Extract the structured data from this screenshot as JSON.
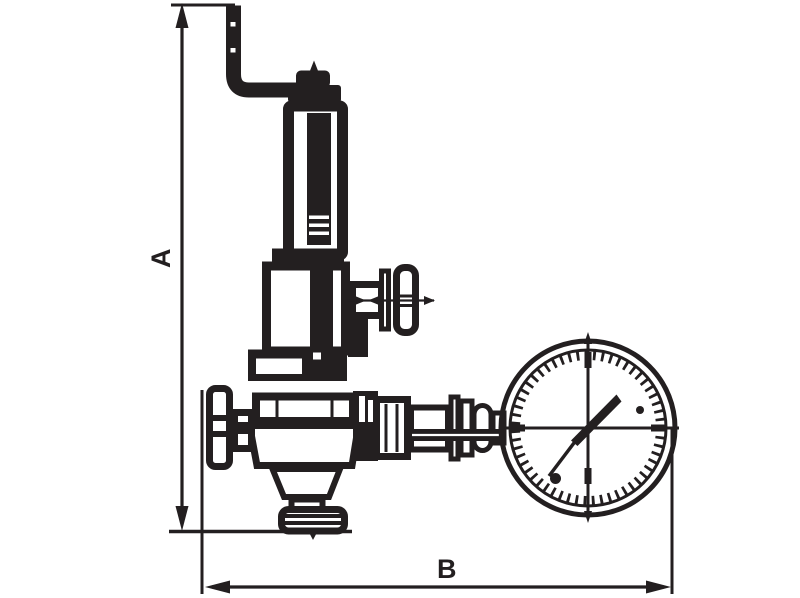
{
  "colors": {
    "ink": "#231f20",
    "paper": "#ffffff"
  },
  "labels": {
    "dimension_vertical": "A",
    "dimension_horizontal": "B"
  }
}
